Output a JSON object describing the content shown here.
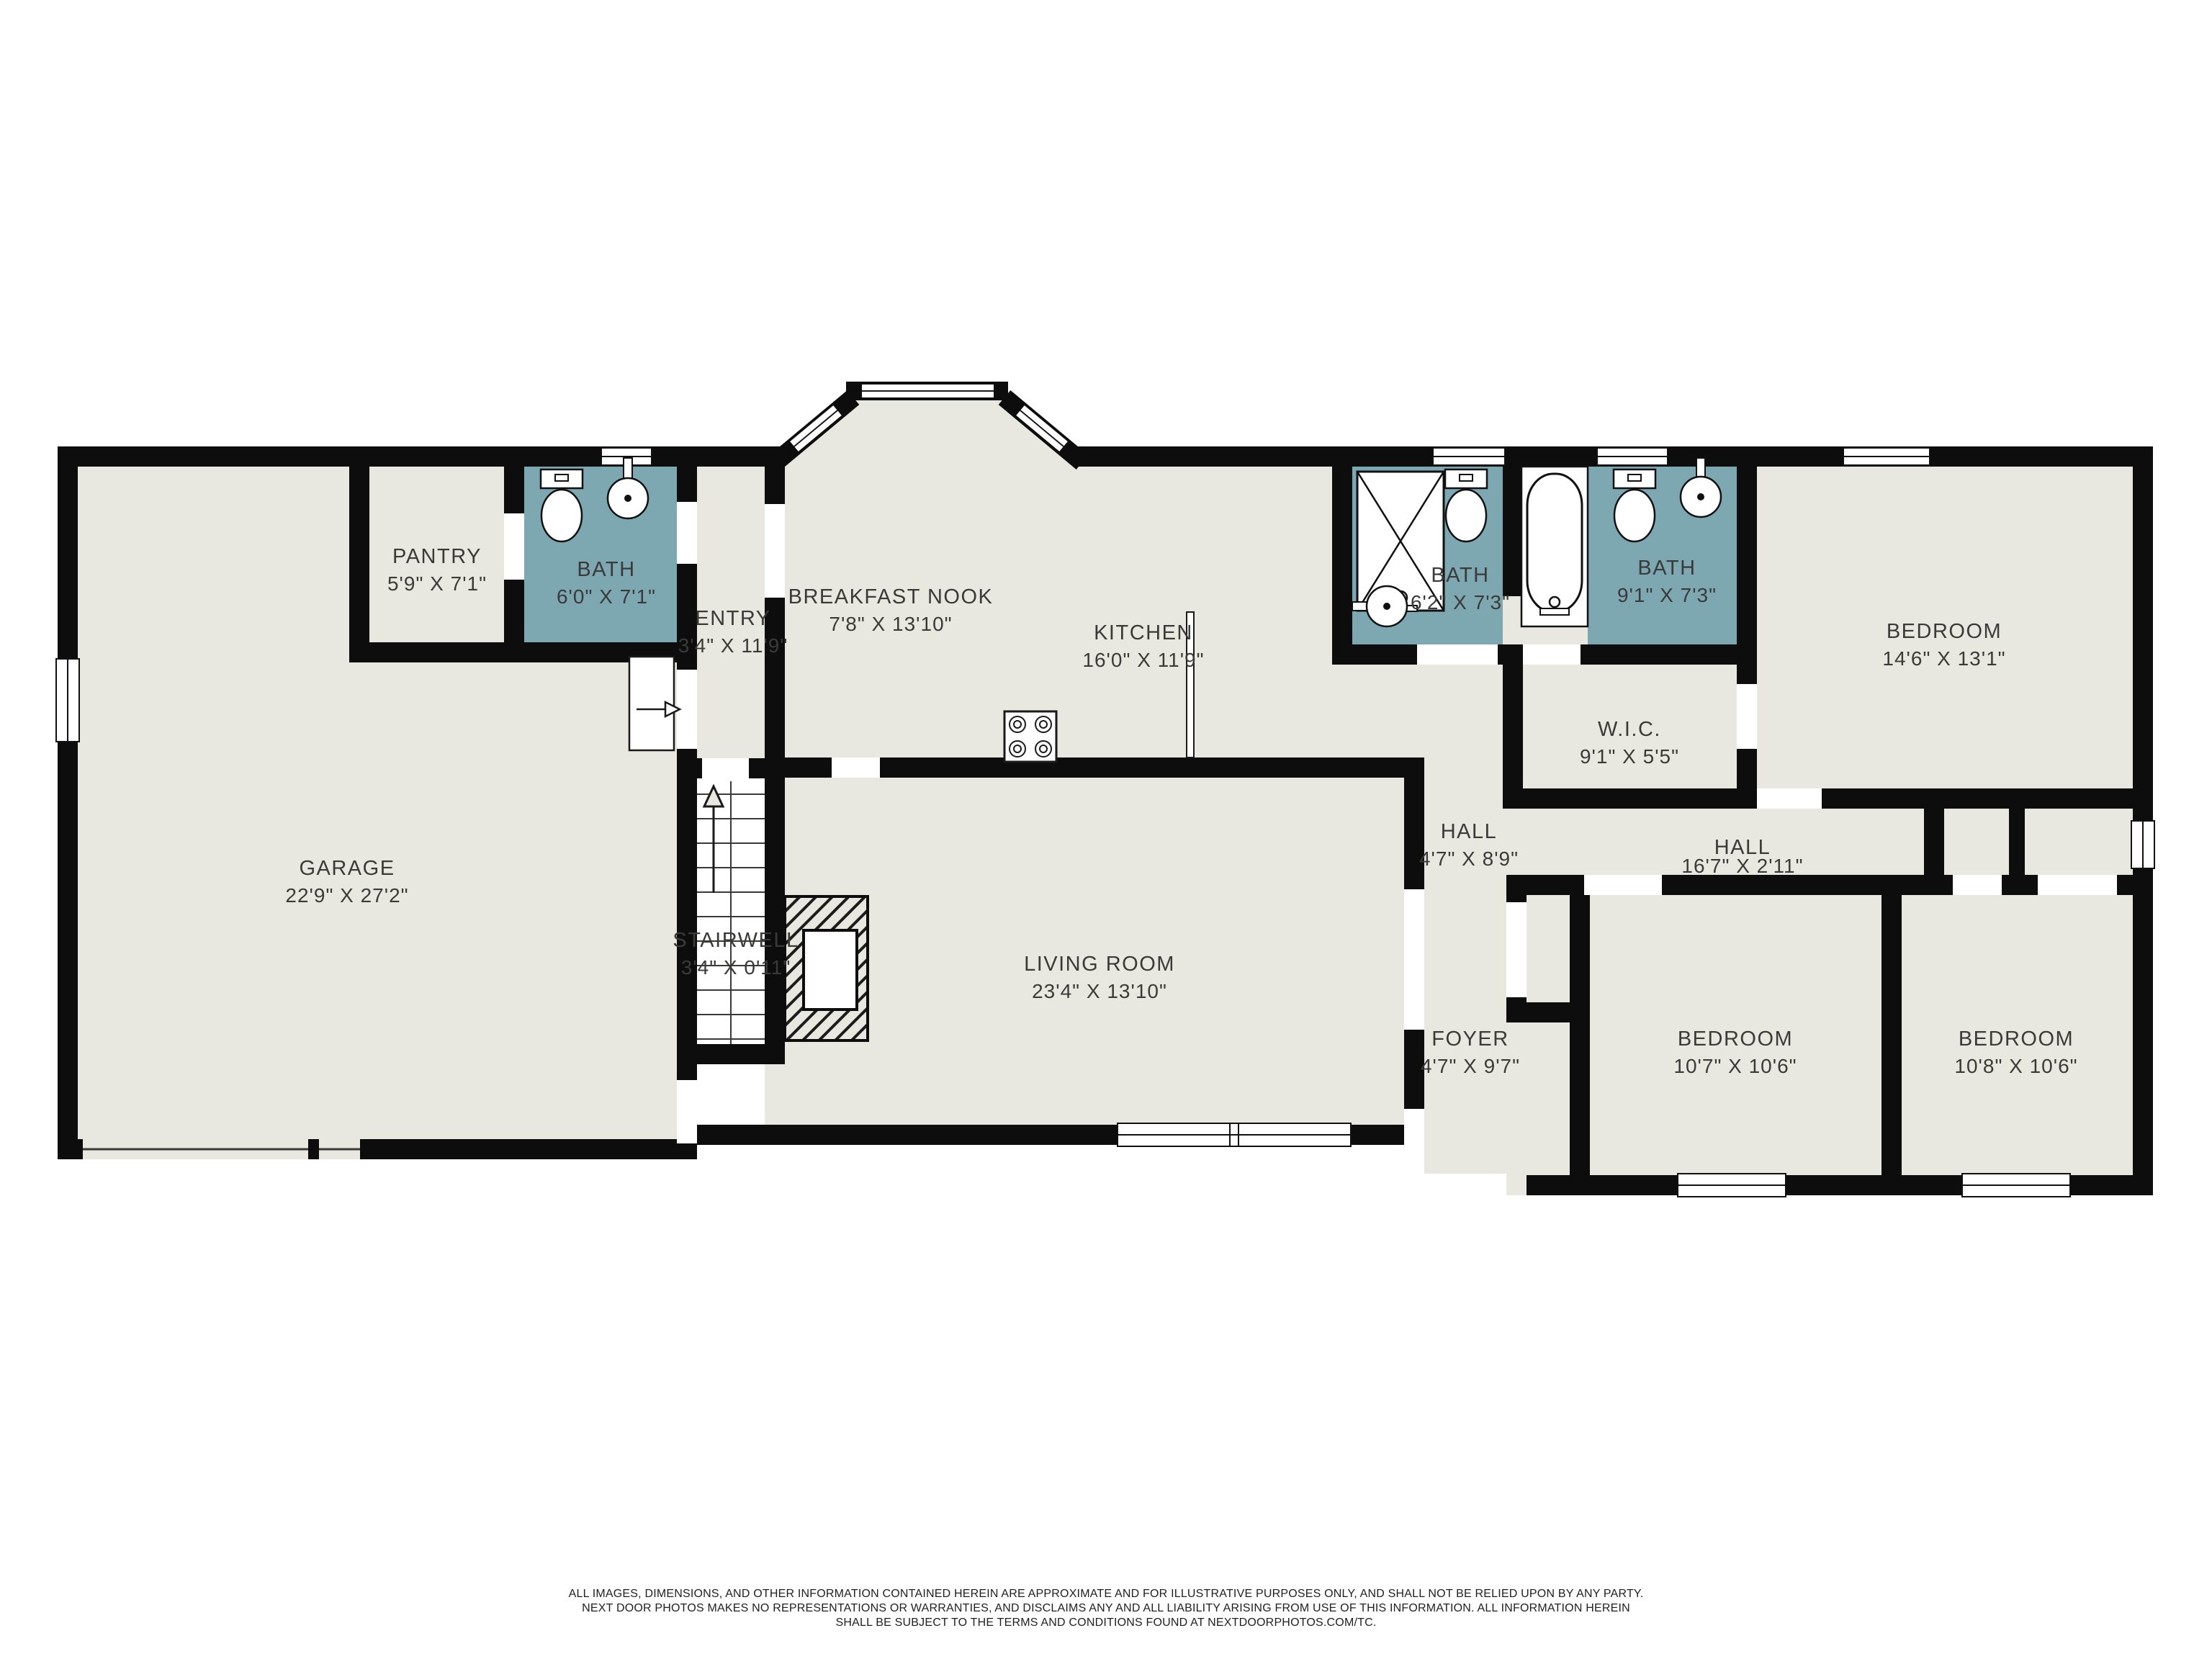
{
  "rooms": [
    {
      "id": "garage",
      "name": "GARAGE",
      "dims": "22'9\" X 27'2\""
    },
    {
      "id": "pantry",
      "name": "PANTRY",
      "dims": "5'9\" X 7'1\""
    },
    {
      "id": "bath-main",
      "name": "BATH",
      "dims": "6'0\" X 7'1\""
    },
    {
      "id": "entry",
      "name": "ENTRY",
      "dims": "3'4\" X 11'9\""
    },
    {
      "id": "breakfast-nook",
      "name": "BREAKFAST NOOK",
      "dims": "7'8\" X 13'10\""
    },
    {
      "id": "kitchen",
      "name": "KITCHEN",
      "dims": "16'0\" X 11'9\""
    },
    {
      "id": "stairwell",
      "name": "STAIRWELL",
      "dims": "3'4\" X 0'11\""
    },
    {
      "id": "living-room",
      "name": "LIVING ROOM",
      "dims": "23'4\" X 13'10\""
    },
    {
      "id": "hall",
      "name": "HALL",
      "dims": "4'7\" X 8'9\""
    },
    {
      "id": "foyer",
      "name": "FOYER",
      "dims": "4'7\" X 9'7\""
    },
    {
      "id": "bath-shower",
      "name": "BATH",
      "dims": "6'2\" X 7'3\""
    },
    {
      "id": "bath-tub",
      "name": "BATH",
      "dims": "9'1\" X 7'3\""
    },
    {
      "id": "wic",
      "name": "W.I.C.",
      "dims": "9'1\" X 5'5\""
    },
    {
      "id": "hall-bedrooms",
      "name": "HALL",
      "dims": "16'7\" X 2'11\""
    },
    {
      "id": "bedroom-primary",
      "name": "BEDROOM",
      "dims": "14'6\" X 13'1\""
    },
    {
      "id": "bedroom-middle",
      "name": "BEDROOM",
      "dims": "10'7\" X 10'6\""
    },
    {
      "id": "bedroom-right",
      "name": "BEDROOM",
      "dims": "10'8\" X 10'6\""
    }
  ],
  "disclaimer": {
    "line1": "ALL IMAGES, DIMENSIONS, AND OTHER INFORMATION CONTAINED HEREIN ARE APPROXIMATE AND FOR ILLUSTRATIVE PURPOSES ONLY, AND SHALL NOT BE RELIED UPON BY ANY PARTY.",
    "line2": "NEXT DOOR PHOTOS MAKES NO REPRESENTATIONS OR WARRANTIES, AND DISCLAIMS ANY AND ALL LIABILITY ARISING FROM USE OF THIS INFORMATION. ALL INFORMATION HEREIN",
    "line3": "SHALL BE SUBJECT TO THE TERMS AND CONDITIONS FOUND AT NEXTDOORPHOTOS.COM/TC."
  },
  "colors": {
    "background": "#ffffff",
    "floor": "#e9e8e0",
    "bath_tile": "#7da7b1",
    "wall": "#0d0d0d",
    "label_text": "#3a3a38"
  }
}
